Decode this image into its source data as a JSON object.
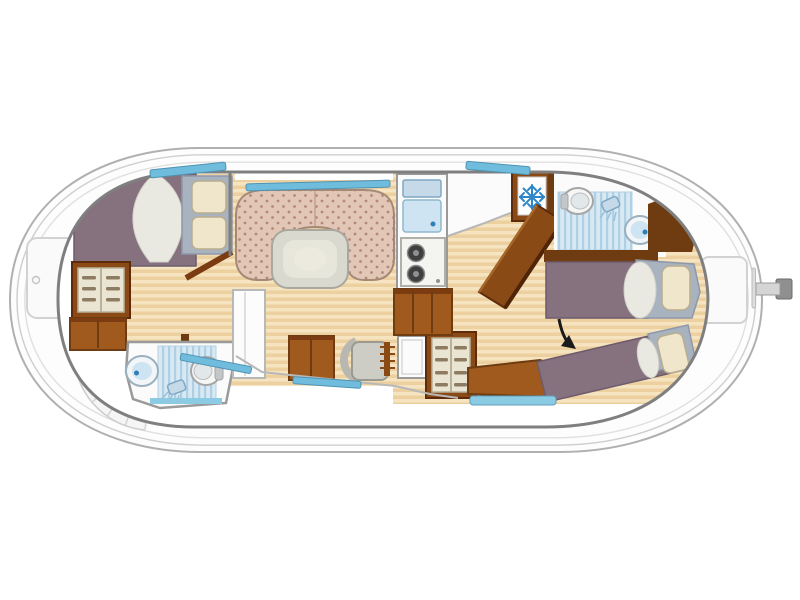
{
  "palette": {
    "hull_fill": "#fdfdfd",
    "hull_stroke": "#b0b0b0",
    "hull_inset1": "#cfcfcf",
    "hull_inset2": "#e0e0e0",
    "cabin_wall": "#7f7f7f",
    "room_white": "#fbfbfb",
    "wood_light": "#f6e3bf",
    "wood_dark": "#ecd0a0",
    "wall_brown": "#6e3c10",
    "wood_trim": "#8a4a16",
    "cabinet_brown": "#a05a1e",
    "cabinet_dark": "#7a3c10",
    "shelf_cream": "#eae5d3",
    "shelf_smudge": "#8d7c62",
    "mattress": "#86727f",
    "mattress_edge": "#6d5a6b",
    "headboard": "#a9b2bf",
    "pillow": "#efe6cb",
    "pillow_edge": "#b9ae8e",
    "duvet": "#e9e9e2",
    "sofa_base": "#e3c7b6",
    "sofa_dot": "#b3887a",
    "sofa_edge": "#a58876",
    "table_fill": "#d9d9cf",
    "table_edge": "#a8a89e",
    "table_inner": "#e6e6da",
    "window_blue": "#6fbcdc",
    "window_edge": "#4f93b3",
    "window_light": "#8ccbe4",
    "tile_light": "#d8e9f4",
    "tile_dark": "#aecfe4",
    "fixture_fill": "#c5d9e8",
    "fixture_edge": "#7fa8c4",
    "sink_inner": "#cfe4f2",
    "tap_blue": "#2d7fb8",
    "porcelain": "#f6f6f4",
    "porcelain_edge": "#a5a5a5",
    "seat_gray": "#cdcdc5",
    "seat_edge": "#9a9a90",
    "steel": "#c2c7cb",
    "snowflake": "#2e86c8",
    "annotation": "#1a1a1a",
    "steps_light": "#a5662a",
    "steps_dark": "#4f2408",
    "fan_line": "#d4d4d4",
    "gray_line": "#b8b8b8"
  },
  "diagram": {
    "kind": "boat-floor-plan",
    "components": [
      "hull",
      "rudder-tiller",
      "bow-hatch",
      "bow-fan-steps",
      "stern-hatch",
      "forward-cabin-double-bed",
      "forward-wardrobe",
      "forward-cabinet",
      "forward-bathroom-sink",
      "forward-bathroom-shower",
      "forward-bathroom-toilet",
      "salon-u-sofa",
      "salon-table",
      "salon-door",
      "helm-cabinet",
      "helm-seat",
      "steering-wheel",
      "helm-console",
      "aft-wardrobe",
      "aft-bench",
      "galley-sink",
      "galley-stove",
      "galley-cabinets",
      "refrigerator",
      "companionway-stairs",
      "aft-bathroom-toilet",
      "aft-bathroom-shower",
      "aft-bathroom-sink",
      "aft-berth-straight",
      "aft-berth-diagonal",
      "annotation-arrow",
      "windows"
    ],
    "icons": [
      "snowflake-icon",
      "shower-head-icon",
      "arrow-icon"
    ]
  }
}
